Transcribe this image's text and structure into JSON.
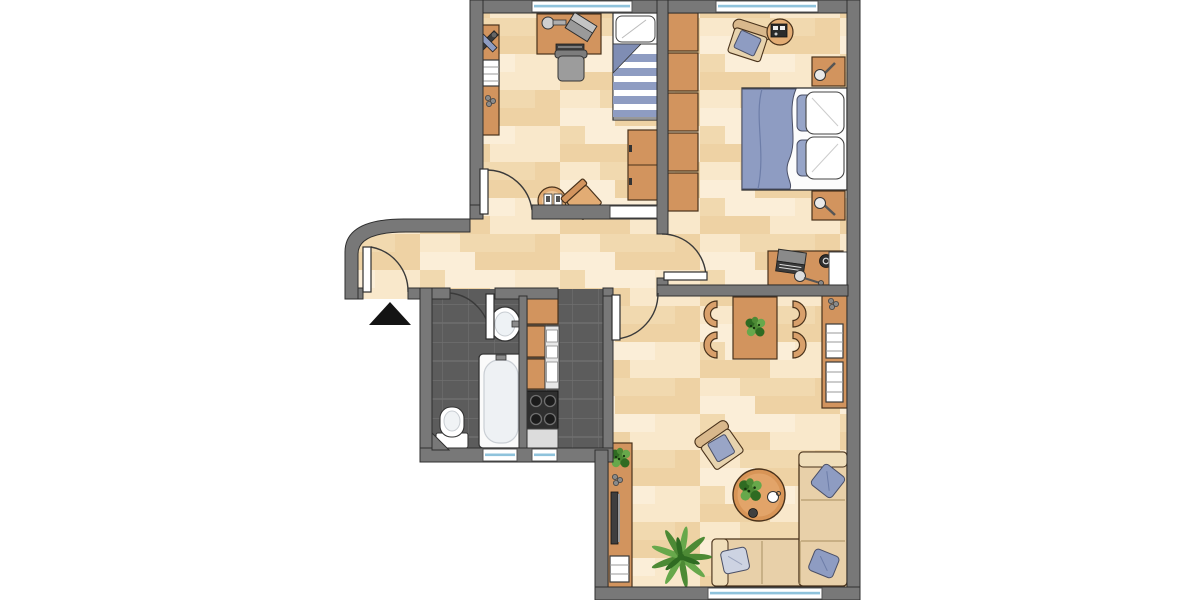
{
  "image": {
    "kind": "apartment floor plan, top-down view",
    "aria_label": "Apartment floor plan",
    "canvas": {
      "width": 1200,
      "height": 600
    },
    "text_labels": [],
    "background": "#ffffff"
  },
  "palette": {
    "bg": "#ffffff",
    "wall": "#787878",
    "wallLine": "#2f2f2f",
    "plankBase": "#f4ddb5",
    "plankA": "#eed2a4",
    "plankB": "#f9e8cb",
    "plankC": "#f1d9af",
    "plankD": "#fbeed8",
    "tile": "#5c5c5c",
    "tileGrout": "#6e6e6e",
    "wood": "#d2945e",
    "woodLight": "#e2ac74",
    "woodDark": "#b97f43",
    "furnLine": "#49321b",
    "white": "#ffffff",
    "windowBlue": "#8fc3dc",
    "windowFrame": "#555555",
    "fabricBlue": "#8e9cc2",
    "fabricBlueDark": "#7f8db4",
    "fabricBlueLight": "#cdd3e2",
    "fabricLine": "#4a4f66",
    "sofa": "#e8d0a9",
    "sofaLight": "#f0deba",
    "seatBeige": "#e7d3ae",
    "backBeige": "#d9b88c",
    "gray": "#9c9c9c",
    "grayDark": "#3a3a3a",
    "grayMid": "#8a8a8a",
    "appliance": "#e8e8e8",
    "green": "#4d8a35",
    "greenDark": "#2f6b22",
    "greenLight": "#67a84b",
    "black": "#141414"
  },
  "rooms": [
    {
      "id": "children-room",
      "position": "top-left",
      "floor": "light wood planks",
      "furniture": [
        "wall shelf board with toy plane, book stack and decor dots",
        "desk with lamp, laptop and keyboard",
        "desk chair",
        "single bed with pillow and blue striped blanket",
        "two-drawer dresser",
        "round side table with two cards",
        "angled chair"
      ],
      "windows": [
        "top exterior wall"
      ],
      "doors": [
        "hinged door to hallway (opens in)",
        "white closed-door opening in bottom wall"
      ]
    },
    {
      "id": "bedroom",
      "position": "top-right",
      "floor": "light wood planks",
      "furniture": [
        "five-section wardrobe along left wall",
        "armchair with blue cushion",
        "round side table with radio",
        "double bed with blue duvet, two white and two blue pillows",
        "nightstand with lamp (top)",
        "nightstand with lamp (bottom)",
        "desk with laptop, speaker and lamp",
        "radiator at right wall"
      ],
      "windows": [
        "top exterior wall"
      ],
      "doors": [
        "hinged door to hallway (opens in)"
      ]
    },
    {
      "id": "hallway",
      "position": "center-left",
      "floor": "light wood planks",
      "features": [
        "curved exterior corner wall",
        "entrance door (opens in)",
        "black entrance arrow marker outside"
      ]
    },
    {
      "id": "bathroom",
      "position": "lower-left",
      "floor": "dark tile",
      "furniture": [
        "wash basin with faucet",
        "bathtub",
        "toilet"
      ],
      "windows": [
        "bottom exterior wall"
      ],
      "doors": [
        "hinged door from hallway (opens in)"
      ],
      "features": [
        "chamfered corner wall at bottom-left"
      ]
    },
    {
      "id": "kitchen",
      "position": "lower-center",
      "floor": "dark tile",
      "furniture": [
        "tall cabinet",
        "two base cabinets",
        "white appliance column",
        "four-burner stove",
        "counter strip"
      ],
      "windows": [
        "bottom exterior wall"
      ],
      "doors": [
        "open doorway to hallway"
      ]
    },
    {
      "id": "living-room",
      "position": "bottom-right",
      "floor": "light wood planks",
      "furniture": [
        "dining table with plant centerpiece",
        "four half-round dining chairs",
        "wall shelf with decor dots and two book stacks",
        "lounge armchair with blue cushion (angled)",
        "round coffee table with plant, cup and bowl",
        "corner sofa with three blue pillows",
        "palm plant",
        "sideboard with plant, decor dots, TV and media stack"
      ],
      "windows": [
        "bottom exterior wall"
      ],
      "doors": [
        "hinged door to hallway (opens in)"
      ]
    }
  ],
  "windows_count": 6,
  "doors": [
    {
      "room": "entrance",
      "hinge": "left",
      "swing": "into hallway"
    },
    {
      "room": "children-room",
      "hinge": "left",
      "swing": "into room"
    },
    {
      "room": "bathroom",
      "hinge": "right",
      "swing": "into room"
    },
    {
      "room": "bedroom",
      "hinge": "bottom",
      "swing": "into room"
    },
    {
      "room": "living-room",
      "hinge": "left",
      "swing": "into room"
    }
  ],
  "symbols": {
    "entrance_arrow": "solid black triangle pointing up, outside entrance door"
  }
}
